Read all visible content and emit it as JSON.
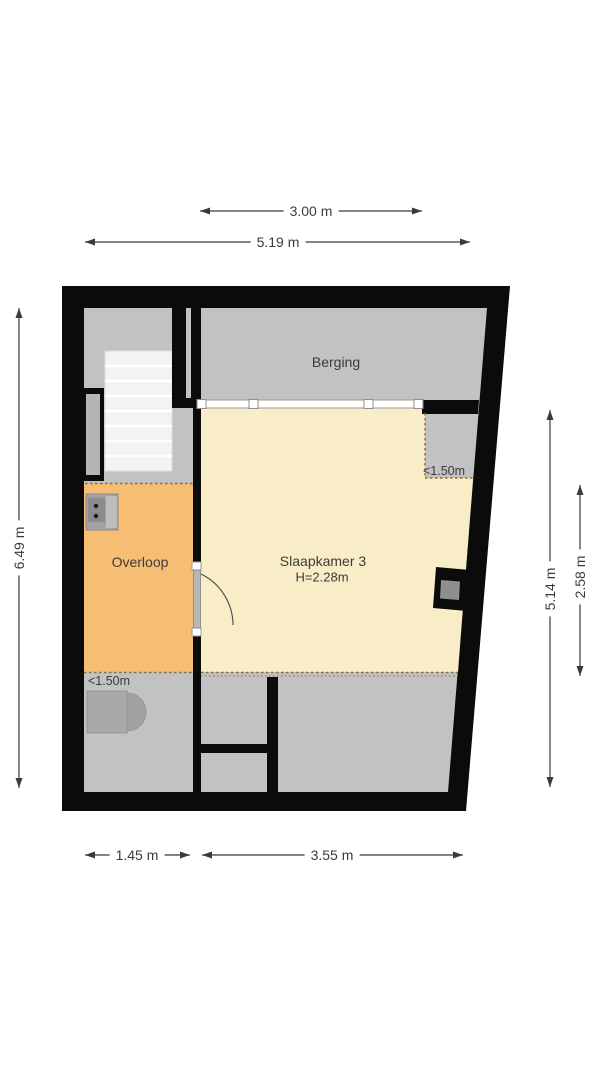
{
  "plan": {
    "type": "floorplan",
    "rooms": {
      "berging": {
        "label": "Berging"
      },
      "slaapkamer3": {
        "label": "Slaapkamer 3",
        "height_note": "H=2.28m"
      },
      "overloop": {
        "label": "Overloop"
      }
    },
    "annotations": {
      "low_clearance_right": "<1.50m",
      "low_clearance_left": "<1.50m"
    },
    "dimensions": {
      "top_inner": "3.00 m",
      "top_outer": "5.19 m",
      "left": "6.49 m",
      "right_outer": "5.14 m",
      "right_inner": "2.58 m",
      "bottom_left": "1.45 m",
      "bottom_right": "3.55 m"
    },
    "colors": {
      "wall": "#0b0b0b",
      "floor_grey": "#c2c2c2",
      "room_yellow": "#f8edc6",
      "room_orange": "#f6be73",
      "stair_tread": "#f3f3f3",
      "dotted_line": "#8a6d3b",
      "dimension_line": "#3a3a3a",
      "object_grey": "#a9a9a9"
    }
  }
}
